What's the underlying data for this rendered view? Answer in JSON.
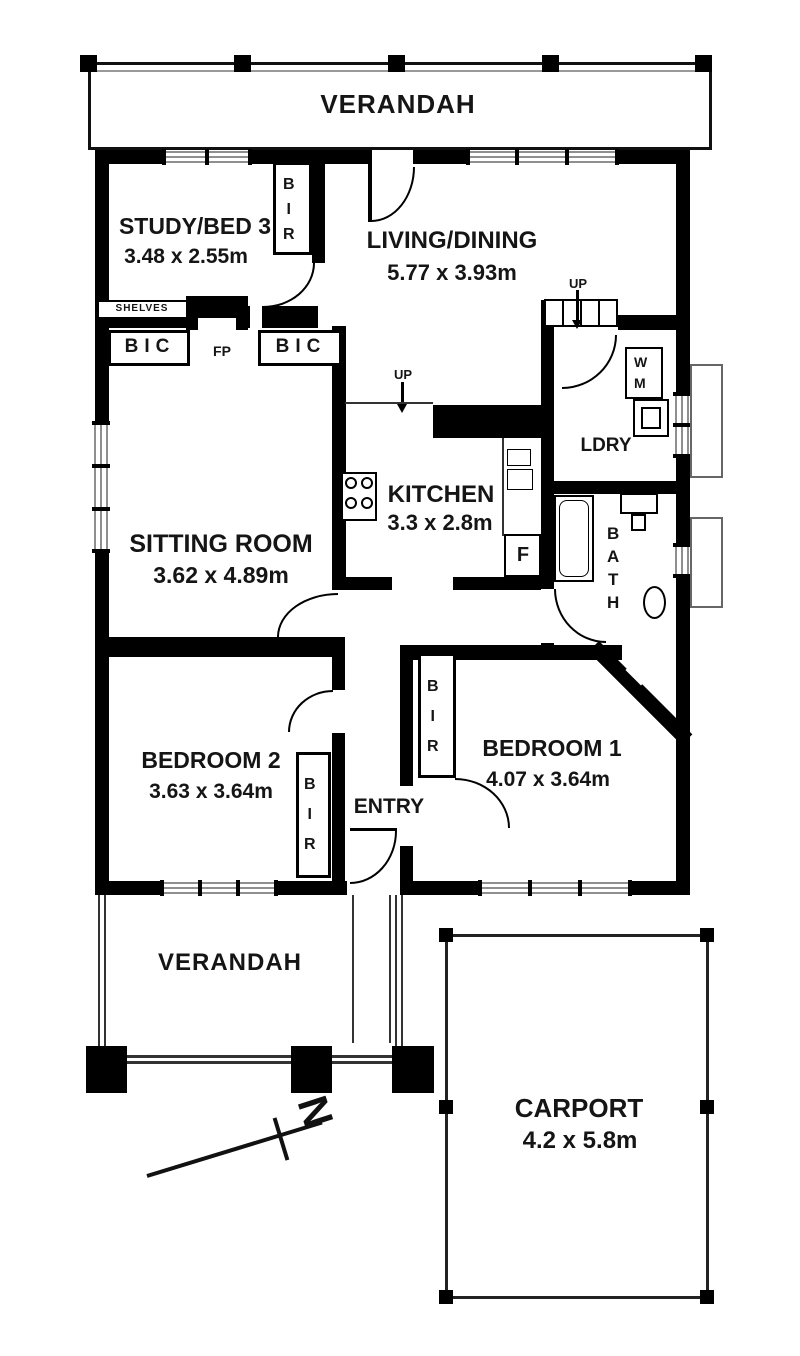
{
  "rooms": {
    "study": {
      "name": "STUDY/BED 3",
      "dims": "3.48 x 2.55m"
    },
    "living": {
      "name": "LIVING/DINING",
      "dims": "5.77 x 3.93m"
    },
    "sitting": {
      "name": "SITTING ROOM",
      "dims": "3.62 x 4.89m"
    },
    "kitchen": {
      "name": "KITCHEN",
      "dims": "3.3 x 2.8m"
    },
    "laundry": {
      "name": "LDRY"
    },
    "bath": {
      "name": "BATH"
    },
    "bedroom2": {
      "name": "BEDROOM 2",
      "dims": "3.63 x 3.64m"
    },
    "bedroom1": {
      "name": "BEDROOM 1",
      "dims": "4.07 x 3.64m"
    },
    "entry": {
      "name": "ENTRY"
    },
    "verandah_top": {
      "name": "VERANDAH"
    },
    "verandah_bottom": {
      "name": "VERANDAH"
    },
    "carport": {
      "name": "CARPORT",
      "dims": "4.2 x 5.8m"
    }
  },
  "features": {
    "bir": "BIR",
    "bic": "BIC",
    "fireplace": "FP",
    "shelves": "SHELVES",
    "washing_machine": "WM",
    "fridge": "F",
    "up": "UP",
    "north": "N"
  },
  "colors": {
    "wall": "#000000",
    "window_line": "#8f8f8f",
    "outline": "#222222",
    "background": "#ffffff"
  }
}
